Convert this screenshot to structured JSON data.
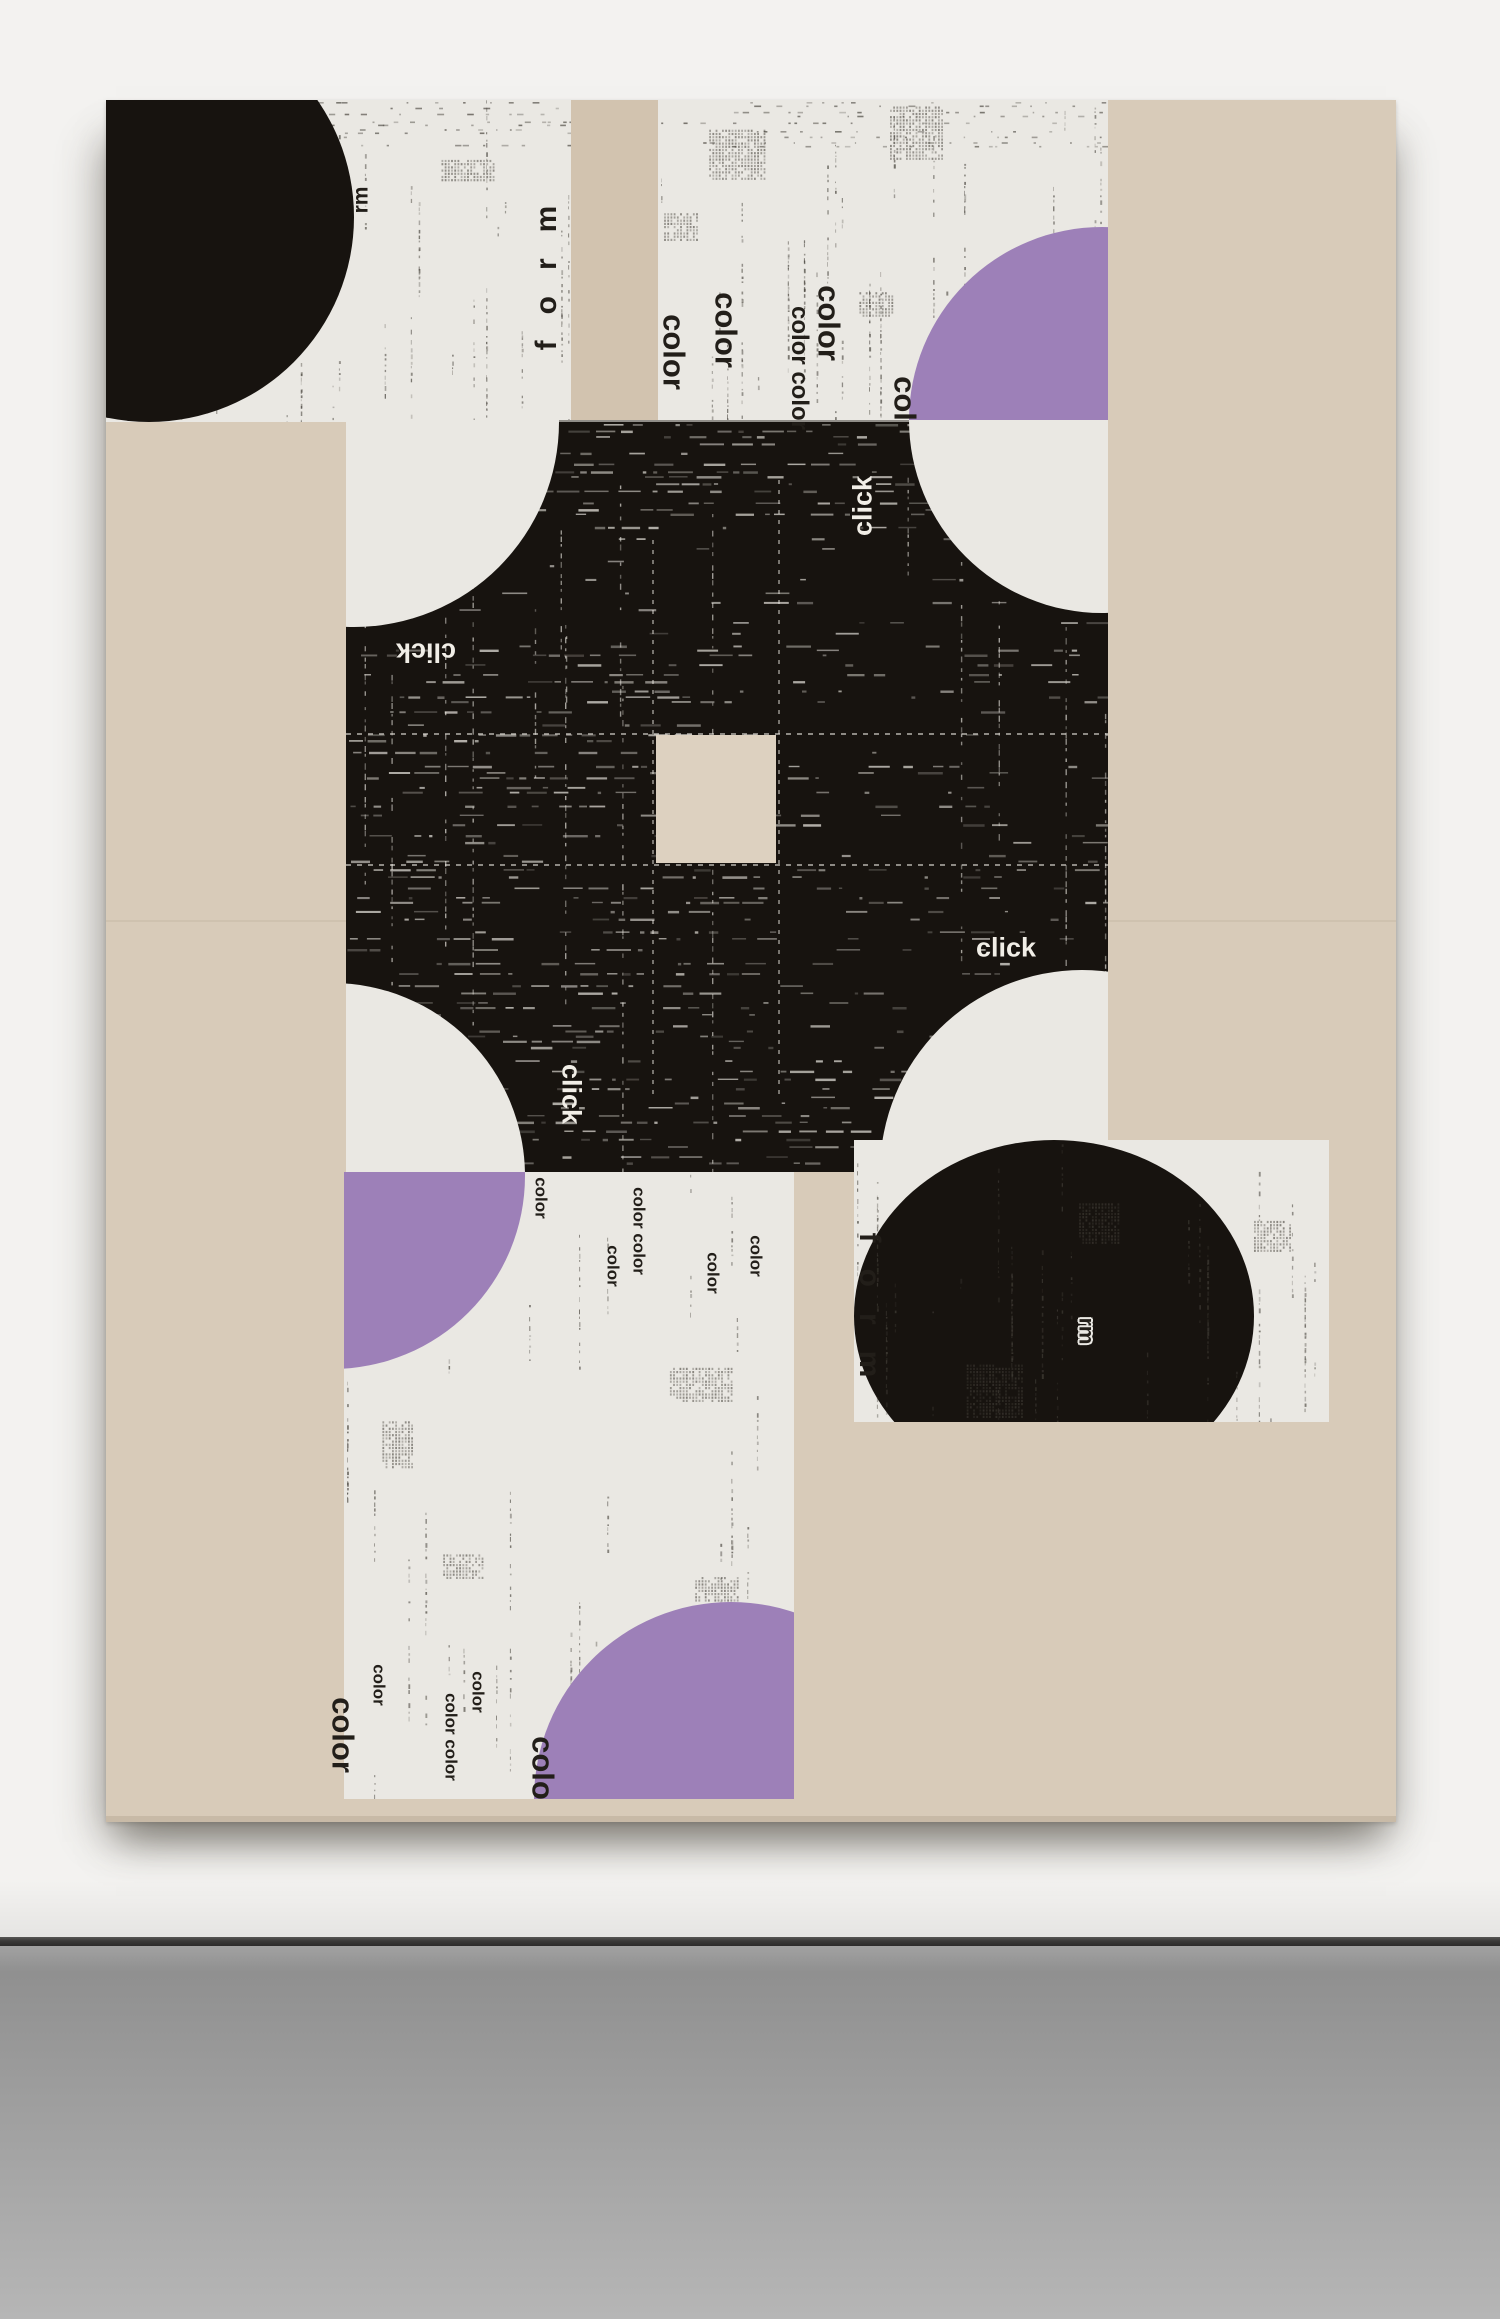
{
  "scene": {
    "description": "photograph of abstract typographic collage painting on gallery wall",
    "palette": {
      "wall": "#f3f2f0",
      "floor_top": "#8d8d8d",
      "floor_bottom": "#b6b6b6",
      "junction": "#3a3938",
      "canvas_beige": "#d8cbb9",
      "canvas_beige_center": "#ddd1c0",
      "panel_white": "#eae8e3",
      "ink_black": "#17130f",
      "purple": "#9d80b8",
      "text_dark": "#221e19",
      "text_light": "#f1eee7"
    }
  },
  "artwork": {
    "words": [
      {
        "id": "w-rm-top",
        "text": "rm",
        "x": 255,
        "y": 100,
        "rot": -90,
        "size": "rm",
        "tone": "dark",
        "halo": true,
        "parent": "artwork"
      },
      {
        "id": "w-form-top",
        "text": "form",
        "x": 441,
        "y": 165,
        "rot": -90,
        "size": "form",
        "tone": "dark",
        "halo": false,
        "parent": "artwork"
      },
      {
        "id": "w-color-b1",
        "text": "color",
        "x": 568,
        "y": 252,
        "rot": 90,
        "size": "m",
        "tone": "dark",
        "halo": false,
        "parent": "artwork"
      },
      {
        "id": "w-color-b2",
        "text": "color",
        "x": 620,
        "y": 230,
        "rot": 90,
        "size": "m",
        "tone": "dark",
        "halo": false,
        "parent": "artwork"
      },
      {
        "id": "w-color-b3",
        "text": "color color",
        "x": 693,
        "y": 268,
        "rot": 90,
        "size": "sm",
        "tone": "dark",
        "halo": false,
        "parent": "artwork"
      },
      {
        "id": "w-color-b4",
        "text": "color",
        "x": 723,
        "y": 223,
        "rot": 90,
        "size": "m",
        "tone": "dark",
        "halo": false,
        "parent": "artwork"
      },
      {
        "id": "w-color-b5",
        "text": "color",
        "x": 799,
        "y": 314,
        "rot": 90,
        "size": "m",
        "tone": "dark",
        "halo": false,
        "parent": "panel-b"
      },
      {
        "id": "w-click-1",
        "text": "click",
        "x": 320,
        "y": 552,
        "rot": 180,
        "size": "click",
        "tone": "light",
        "halo": false,
        "parent": "artwork"
      },
      {
        "id": "w-click-2",
        "text": "click",
        "x": 757,
        "y": 406,
        "rot": -90,
        "size": "click",
        "tone": "light",
        "halo": false,
        "parent": "artwork"
      },
      {
        "id": "w-click-3",
        "text": "click",
        "x": 465,
        "y": 994,
        "rot": 90,
        "size": "click",
        "tone": "light",
        "halo": false,
        "parent": "artwork"
      },
      {
        "id": "w-click-4",
        "text": "click",
        "x": 900,
        "y": 848,
        "rot": 0,
        "size": "click",
        "tone": "light",
        "halo": false,
        "parent": "artwork"
      },
      {
        "id": "w-color-c1",
        "text": "color",
        "x": 435,
        "y": 1098,
        "rot": 90,
        "size": "xs",
        "tone": "dark",
        "halo": false,
        "parent": "panel-c"
      },
      {
        "id": "w-color-c2",
        "text": "color",
        "x": 507,
        "y": 1166,
        "rot": 90,
        "size": "xs",
        "tone": "dark",
        "halo": false,
        "parent": "artwork"
      },
      {
        "id": "w-color-c3",
        "text": "color color",
        "x": 533,
        "y": 1131,
        "rot": 90,
        "size": "xs",
        "tone": "dark",
        "halo": false,
        "parent": "artwork"
      },
      {
        "id": "w-color-c4",
        "text": "color",
        "x": 607,
        "y": 1173,
        "rot": 90,
        "size": "xs",
        "tone": "dark",
        "halo": false,
        "parent": "artwork"
      },
      {
        "id": "w-color-c5",
        "text": "color",
        "x": 650,
        "y": 1156,
        "rot": 90,
        "size": "xs",
        "tone": "dark",
        "halo": false,
        "parent": "artwork"
      },
      {
        "id": "w-color-c6",
        "text": "color",
        "x": 237,
        "y": 1635,
        "rot": 90,
        "size": "m",
        "tone": "dark",
        "halo": false,
        "parent": "artwork"
      },
      {
        "id": "w-color-c7",
        "text": "color",
        "x": 273,
        "y": 1585,
        "rot": 90,
        "size": "xs",
        "tone": "dark",
        "halo": false,
        "parent": "artwork"
      },
      {
        "id": "w-color-c8",
        "text": "color color",
        "x": 345,
        "y": 1637,
        "rot": 90,
        "size": "xs",
        "tone": "dark",
        "halo": false,
        "parent": "artwork"
      },
      {
        "id": "w-color-c9",
        "text": "color",
        "x": 372,
        "y": 1592,
        "rot": 90,
        "size": "xs",
        "tone": "dark",
        "halo": false,
        "parent": "artwork"
      },
      {
        "id": "w-color-c10",
        "text": "color",
        "x": 437,
        "y": 1674,
        "rot": 90,
        "size": "m",
        "tone": "dark",
        "halo": false,
        "parent": "panel-c"
      },
      {
        "id": "w-form-bottom",
        "text": "form",
        "x": 763,
        "y": 1218,
        "rot": 90,
        "size": "form",
        "tone": "dark",
        "halo": false,
        "parent": "artwork"
      },
      {
        "id": "w-rm-bottom",
        "text": "rm",
        "x": 980,
        "y": 1231,
        "rot": 90,
        "size": "rm",
        "tone": "dark",
        "halo": true,
        "parent": "artwork"
      }
    ]
  }
}
